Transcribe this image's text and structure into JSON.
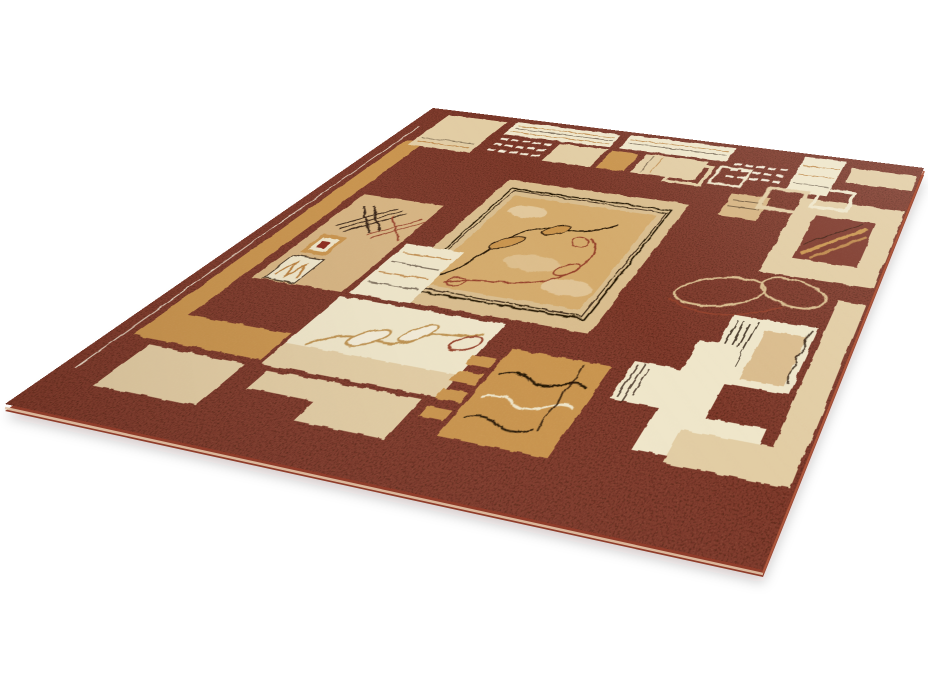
{
  "image": {
    "type": "product-photo",
    "subject": "Rectangular patterned area rug photographed at a perspective angle on a plain white background",
    "background_color": "#ffffff"
  },
  "rug": {
    "style": "geometric patchwork rug with beige blocks, stripe bars, sketch crosshatches and leaf-vine motifs on a mottled maroon field",
    "motifs": [
      "geometric blocks",
      "stripe bars",
      "crosshatch sketches",
      "leaf vines",
      "central leaf medallion",
      "zigzag M square",
      "red diamond inset",
      "wave lines",
      "stepped blocks",
      "white dash grids"
    ],
    "flat_size": [
      840,
      600
    ],
    "corners": {
      "far": [
        433,
        108
      ],
      "right": [
        924,
        168
      ],
      "near": [
        763,
        570
      ],
      "left": [
        5,
        404
      ]
    },
    "palette": {
      "white_bg": "#ffffff",
      "maroon": "#7d392a",
      "maroon_dark": "#2a0f08",
      "maroon_light": "#b05a3e",
      "beige": "#e2cda4",
      "frame_beige": "#d9bd8e",
      "cream": "#efe6ca",
      "cream_bright": "#f3ecd8",
      "tan": "#c9944e",
      "tan_deep": "#b97f3e",
      "sand": "#d6b482",
      "sand_inner": "#d4ab6c",
      "dark_line": "#241206",
      "red_accent": "#8d2c1e",
      "red_vine": "#94402a",
      "gold_vine": "#bd9150",
      "binding": "#a0432d",
      "side_fill": "#8f3c2a",
      "side_highlight": "#e3c5a8",
      "shadow": "rgba(40,15,8,0.20)"
    }
  }
}
